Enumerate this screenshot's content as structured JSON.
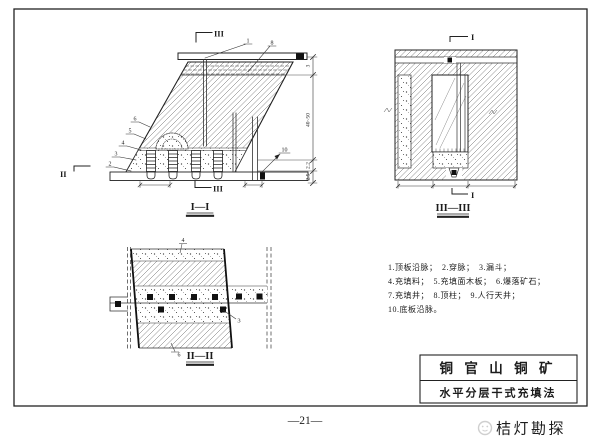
{
  "page": {
    "page_number": "—21—",
    "watermark_text": "桔灯勘探"
  },
  "title_block": {
    "row1": "铜 官 山 铜 矿",
    "row2": "水平分层干式充填法"
  },
  "legend": {
    "line1": "1.顶板沿脉；　2.穿脉；　3.漏斗；",
    "line2": "4.充填料；　5.充填面木板；　6.爆落矿石；",
    "line3": "7.充填井；　8.顶柱；　9.人行天井；",
    "line4": "10.底板沿脉。"
  },
  "view1": {
    "label": "I—I",
    "flag_top": "III",
    "flag_bottom": "III",
    "flag_side": "II",
    "callout_1": "1",
    "callout_8": "8",
    "callout_6": "6",
    "callout_5": "5",
    "callout_4": "4",
    "callout_3": "3",
    "callout_2": "2",
    "callout_10": "10",
    "dim_top": "3",
    "dim_mid": "40~50",
    "dim_b1": "2.2",
    "dim_b2": "2.5"
  },
  "view2": {
    "label": "II—II",
    "callout_top": "4",
    "callout_right": "3",
    "callout_bottom": "6"
  },
  "view3": {
    "label": "III—III",
    "flag_top": "I",
    "flag_bottom": "I"
  }
}
